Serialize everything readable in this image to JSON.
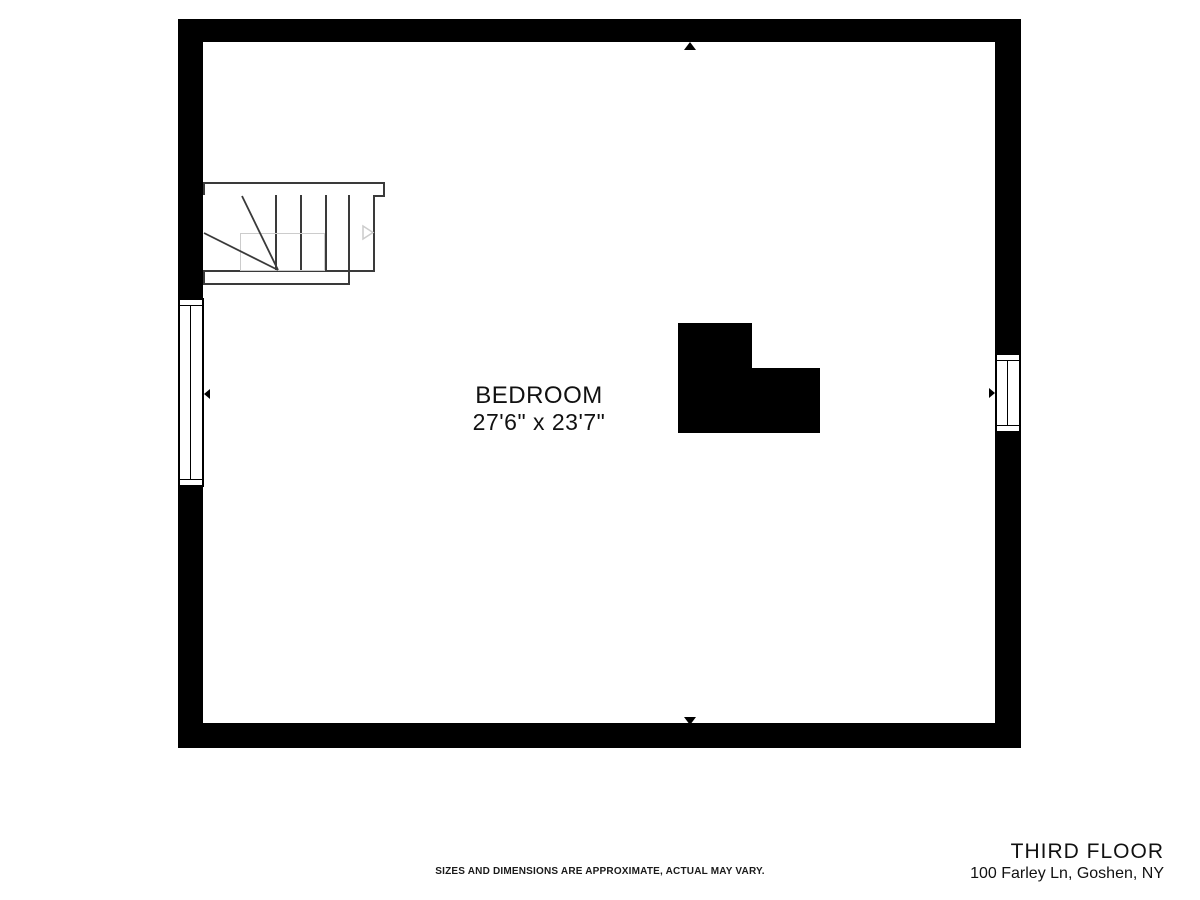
{
  "plan": {
    "room": {
      "name": "BEDROOM",
      "dimensions": "27'6\" x 23'7\""
    }
  },
  "footer": {
    "disclaimer": "SIZES AND DIMENSIONS ARE APPROXIMATE, ACTUAL MAY VARY.",
    "floor_label": "THIRD FLOOR",
    "address": "100 Farley Ln, Goshen, NY"
  },
  "colors": {
    "wall": "#000000",
    "background": "#ffffff",
    "stair_outline": "#3a3a3a",
    "faded_detail": "#cccccc",
    "text": "#111111",
    "footer_text": "#1a1a1a"
  }
}
